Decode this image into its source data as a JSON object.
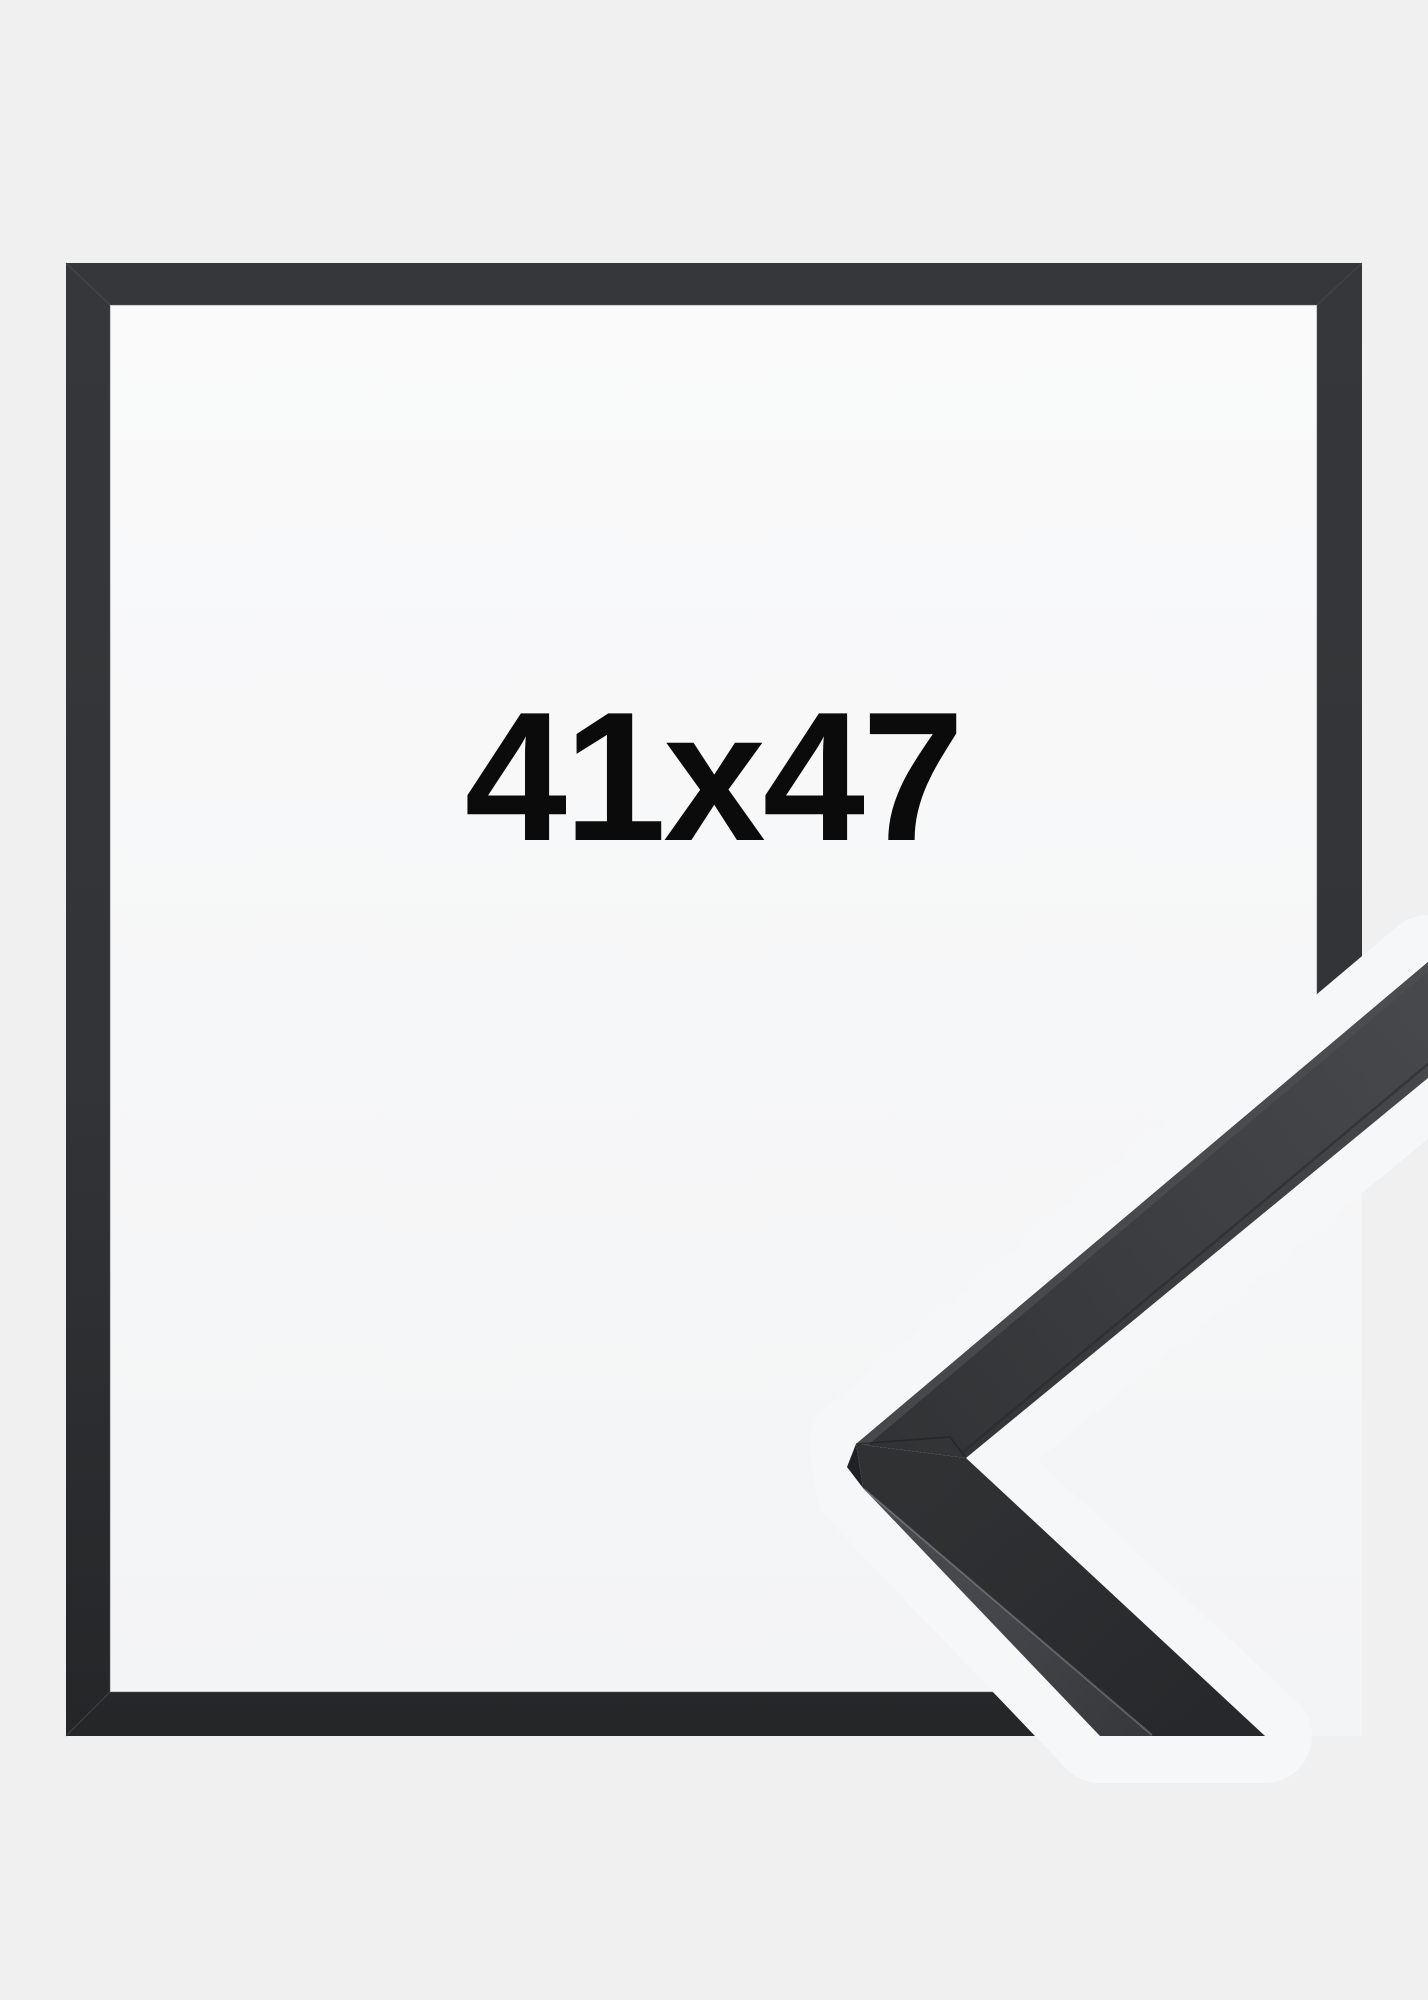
{
  "product": {
    "size_label": "41x47",
    "description": "black picture frame product photo with corner profile sample"
  },
  "colors": {
    "background": "#f0f0f1",
    "paper_top": "#fafafb",
    "paper_bottom": "#f3f4f5",
    "gap_halo": "#f6f7f8",
    "frame_dark_top": "#35373a",
    "frame_dark_bottom": "#242628",
    "corner_upper_front_start": "#303234",
    "corner_upper_front_end": "#47494c",
    "corner_upper_edge_light": "#4c4e51",
    "corner_lower_front": "#2b2d30",
    "corner_side_light": "#45474b",
    "corner_end_sliver": "#202124",
    "corner_highlight": "#909294",
    "seam_line": "#1c1d1f",
    "size_text": "#0b0b0c"
  }
}
